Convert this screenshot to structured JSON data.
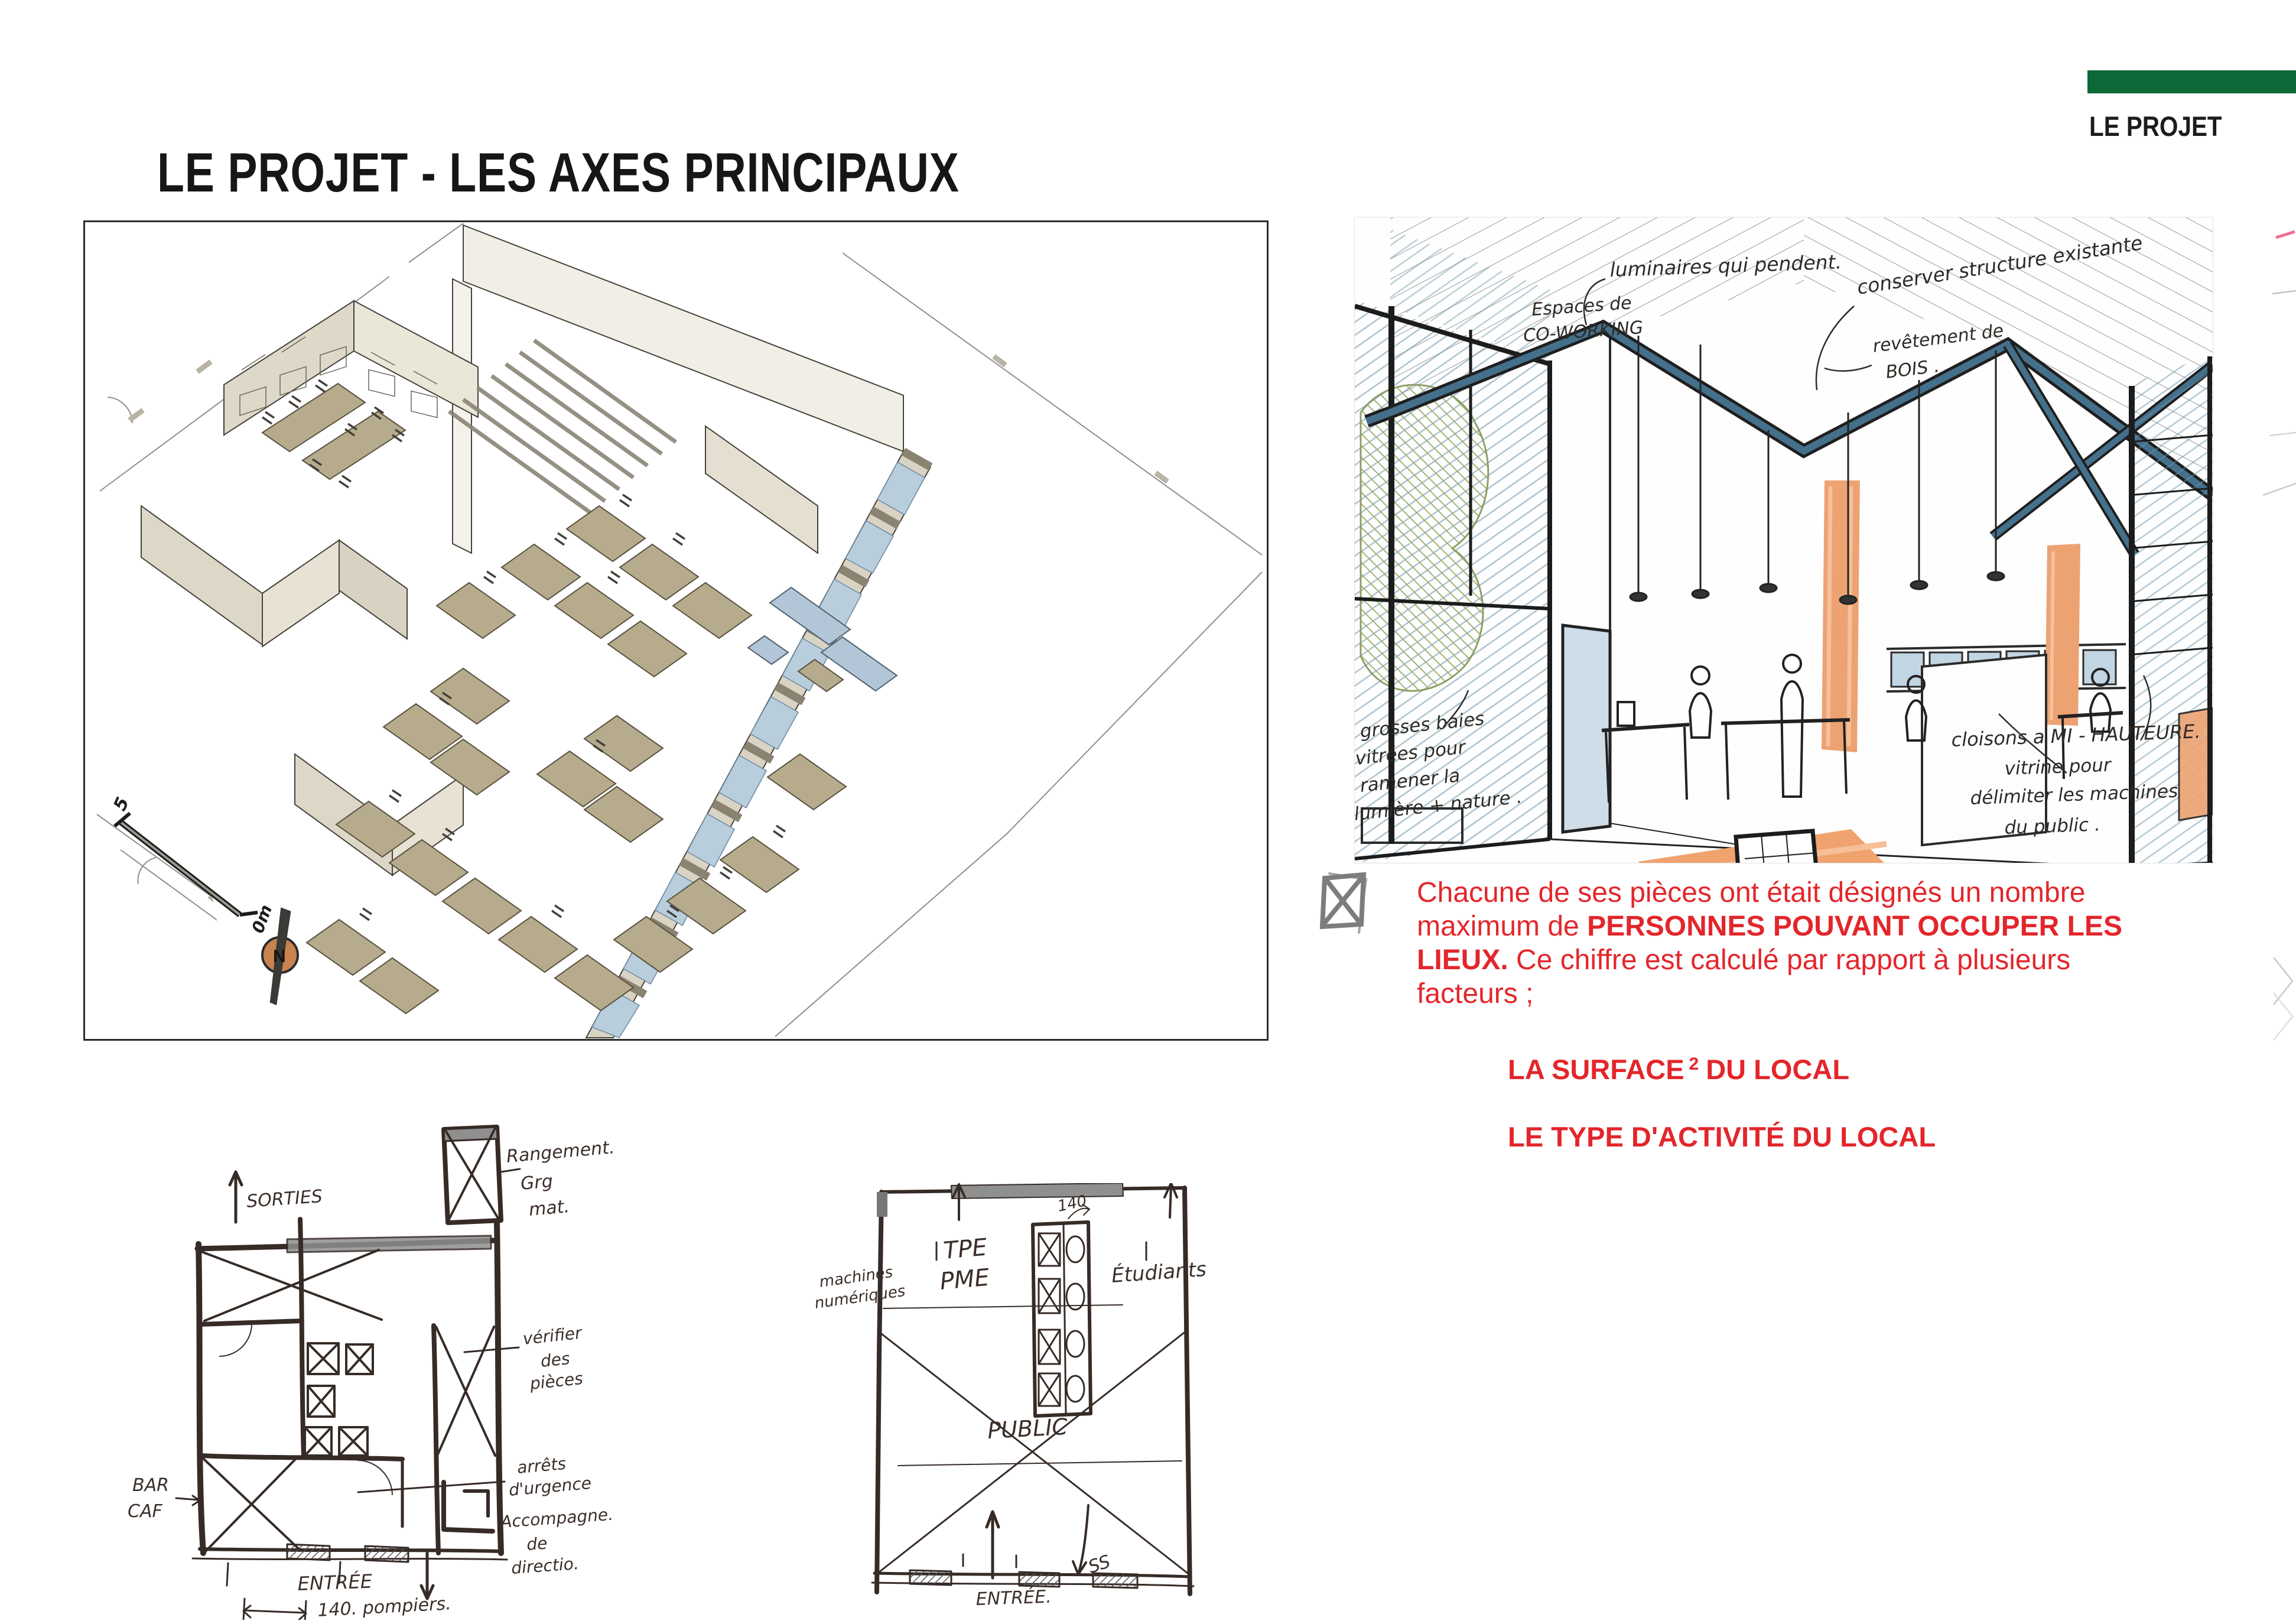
{
  "page": {
    "title": "LE PROJET - LES AXES PRINCIPAUX",
    "corner_label": "LE PROJET"
  },
  "colors": {
    "accent_green": "#0d6a38",
    "accent_red": "#e3262b"
  },
  "axon": {
    "scale_start": "5",
    "scale_end": "0m",
    "north": "N"
  },
  "sketch": {
    "annotations": {
      "luminaires": "luminaires qui pendent.",
      "conserver": "conserver structure existante",
      "revetement": [
        "revêtement de",
        "BOIS ."
      ],
      "espaces": [
        "Espaces de",
        "CO-WORKING"
      ],
      "baies": [
        "grosses baies",
        "vitrées pour",
        "ramener la",
        "lumière + nature ."
      ],
      "cloisons": "cloisons a MI - HAUTEURE.",
      "vitrine": [
        "vitrine pour",
        "délimiter les machines",
        "du public ."
      ]
    }
  },
  "note": {
    "lines": [
      [
        {
          "t": "Chacune de ses pièces ont était désignés un nombre"
        }
      ],
      [
        {
          "t": "maximum de "
        },
        {
          "t": "PERSONNES POUVANT OCCUPER LES"
        }
      ],
      [
        {
          "t": "LIEUX."
        },
        {
          "t": " Ce chiffre est calculé par rapport à plusieurs"
        }
      ],
      [
        {
          "t": "facteurs ;"
        }
      ]
    ],
    "factor1": {
      "pre": "LA SURFACE",
      "sup": "2",
      "post": "DU LOCAL"
    },
    "factor2": "LE TYPE D'ACTIVITÉ DU LOCAL"
  },
  "plan_left": {
    "labels": {
      "sorties": "SORTIES",
      "rangement": [
        "Rangement.",
        "Grg",
        "mat."
      ],
      "verifier": [
        "vérifier",
        "des",
        "pièces"
      ],
      "arrets": [
        "arrêts",
        "d'urgence"
      ],
      "accompagne": [
        "Accompagne.",
        "de",
        "directio."
      ],
      "bar": [
        "BAR",
        "CAF"
      ],
      "entree": "ENTRÉE",
      "pompiers": "140. pompiers."
    }
  },
  "plan_middle": {
    "labels": {
      "machines": [
        "machines",
        "numériques"
      ],
      "tpe": [
        "TPE",
        "PME"
      ],
      "count": "140",
      "etudiants": "Étudiants",
      "public": "PUBLIC",
      "entree": "ENTRÉE.",
      "ss": "SS"
    }
  }
}
